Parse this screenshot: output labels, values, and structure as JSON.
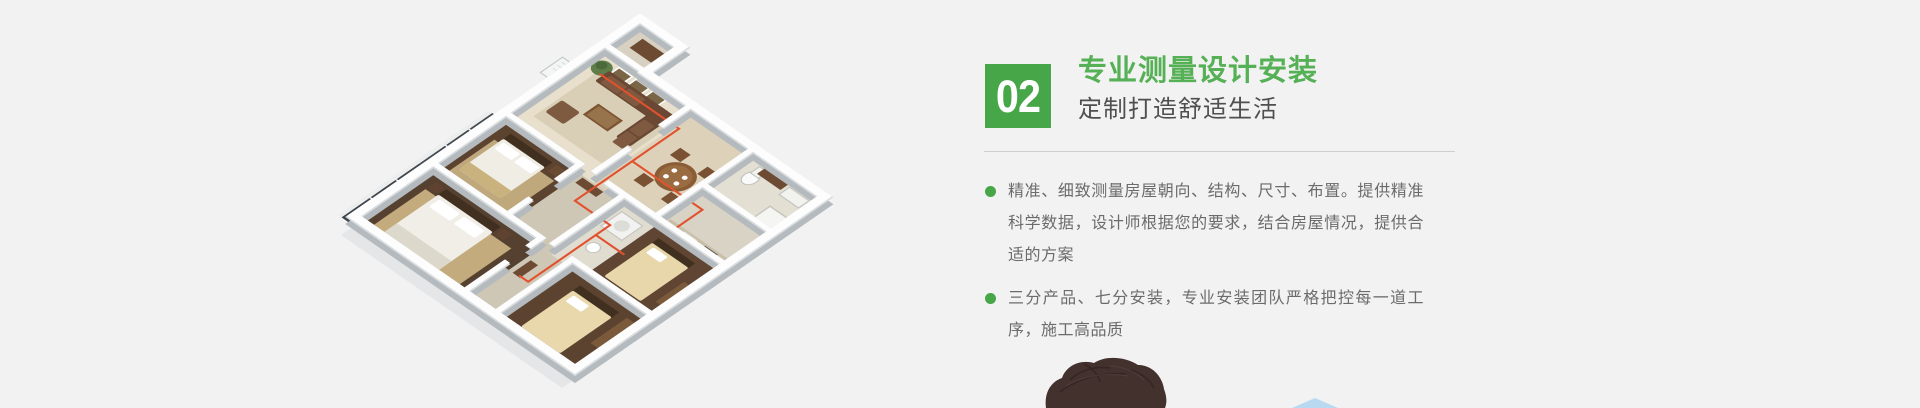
{
  "page": {
    "background": "#f2f2f2"
  },
  "step_section": {
    "badge": {
      "number": "02",
      "bg_color": "#46a648",
      "text_color": "#ffffff"
    },
    "title": "专业测量设计安装",
    "title_color": "#56b056",
    "subtitle": "定制打造舒适生活",
    "bullet_color": "#46a648",
    "bullets": [
      "精准、细致测量房屋朝向、结构、尺寸、布置。提供精准科学数据，设计师根据您的要求，结合房屋情况，提供合适的方案",
      "三分产品、七分安装，专业安装团队严格把控每一道工序，施工高品质"
    ]
  },
  "illustration": {
    "label": "isometric-3d-apartment-floor-plan",
    "pipe_color": "#e2512e"
  },
  "photo_peek": {
    "label": "top-of-person-head"
  },
  "decor": {
    "triangle_color": "#b9d9f0"
  }
}
